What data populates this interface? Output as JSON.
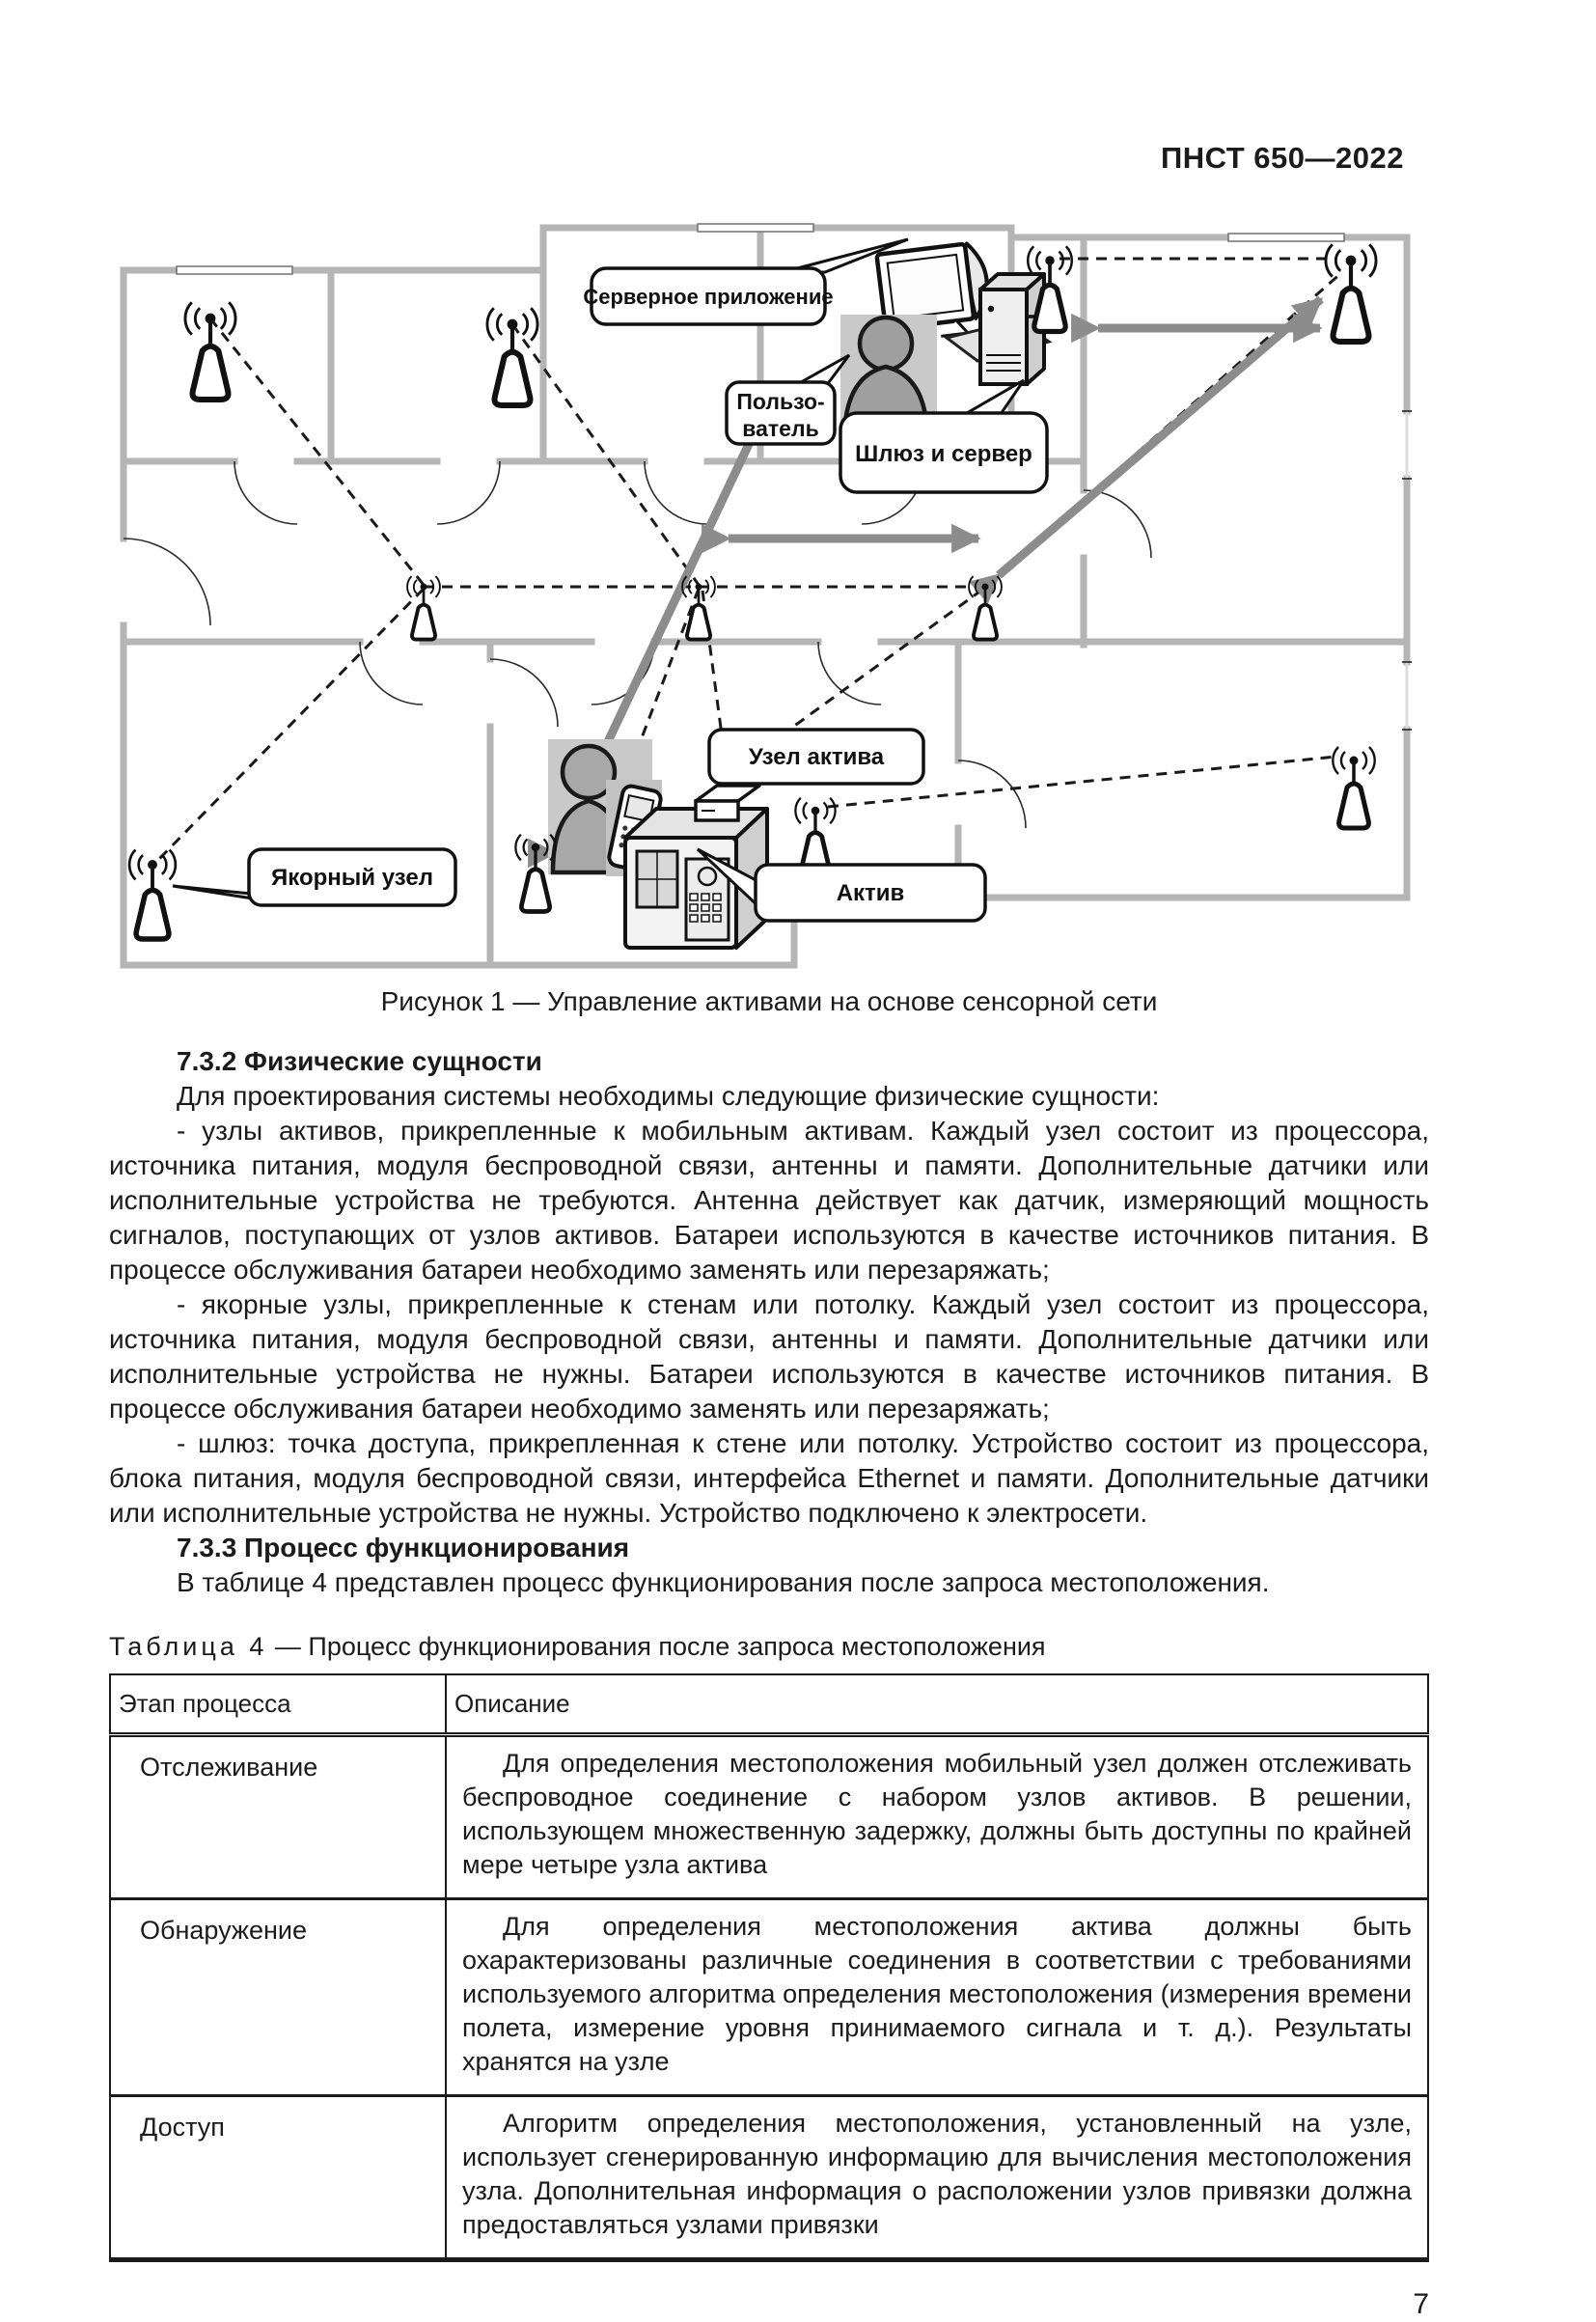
{
  "header": {
    "doc_code": "ПНСТ 650—2022"
  },
  "figure": {
    "caption": "Рисунок 1 — Управление активами на основе сенсорной сети",
    "labels": {
      "server_app": "Серверное приложение",
      "user_line1": "Пользо-",
      "user_line2": "ватель",
      "gateway_server": "Шлюз и сервер",
      "asset_node": "Узел актива",
      "anchor_node": "Якорный узел",
      "asset": "Актив"
    }
  },
  "sections": [
    {
      "heading": "7.3.2  Физические сущности",
      "paragraphs": [
        "Для проектирования системы необходимы следующие физические сущности:",
        "- узлы активов, прикрепленные к мобильным активам. Каждый узел состоит из процессора, источника питания, модуля беспроводной связи, антенны и памяти. Дополнительные датчики или исполнительные устройства не требуются. Антенна действует как датчик, измеряющий мощность сигналов, поступающих от узлов активов. Батареи используются в качестве источников питания. В процессе обслуживания батареи необходимо заменять или перезаряжать;",
        "- якорные узлы, прикрепленные к стенам или потолку. Каждый узел состоит из процессора, источника питания, модуля беспроводной связи, антенны и памяти. Дополнительные датчики или исполнительные устройства не нужны. Батареи используются в качестве источников питания. В процессе обслуживания батареи необходимо заменять или перезаряжать;",
        "- шлюз: точка доступа, прикрепленная к стене или потолку. Устройство состоит из процессора, блока питания, модуля беспроводной связи, интерфейса Ethernet и памяти. Дополнительные датчики или исполнительные устройства не нужны. Устройство подключено к электросети."
      ]
    },
    {
      "heading": "7.3.3  Процесс функционирования",
      "paragraphs": [
        "В таблице 4 представлен процесс функционирования после запроса местоположения."
      ]
    }
  ],
  "table": {
    "caption_label": "Таблица  4",
    "caption_text": "— Процесс функционирования после запроса местоположения",
    "columns": [
      "Этап процесса",
      "Описание"
    ],
    "rows": [
      {
        "stage": "Отслеживание",
        "description": "Для определения местоположения мобильный узел должен отслеживать беспроводное соединение с набором узлов активов. В решении, использующем множественную задержку, должны быть доступны по крайней мере четыре узла актива"
      },
      {
        "stage": "Обнаружение",
        "description": "Для определения местоположения актива должны быть охарактеризованы различные соединения в соответствии с требованиями используемого алгоритма определения местоположения (измерения времени полета, измерение уровня принимаемого сигнала и т. д.). Результаты хранятся на узле"
      },
      {
        "stage": "Доступ",
        "description": "Алгоритм определения местоположения, установленный на узле, использует сгенерированную информацию для вычисления местоположения узла. Дополнительная информация о расположении узлов привязки должна предоставляться узлами привязки"
      }
    ]
  },
  "footer": {
    "page_number": "7"
  }
}
